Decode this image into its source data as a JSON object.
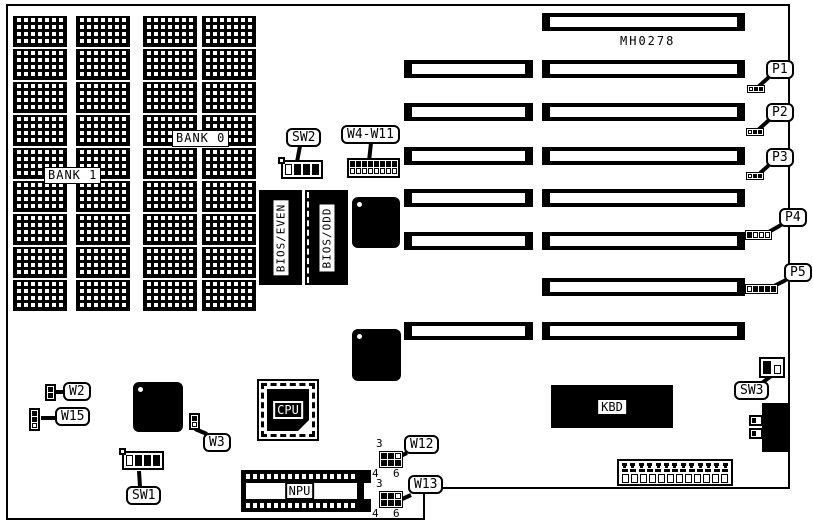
{
  "board": {
    "id": "MH0278",
    "banks": {
      "bank0": "BANK 0",
      "bank1": "BANK 1"
    },
    "memory": {
      "columns": 4,
      "chips_per_column": 9
    },
    "chips": {
      "cpu": "CPU",
      "npu": "NPU",
      "kbd": "KBD",
      "bios_even": "BIOS/EVEN",
      "bios_odd": "BIOS/ODD"
    },
    "switches": {
      "sw1": "SW1",
      "sw2": "SW2",
      "sw3": "SW3"
    },
    "jumpers": {
      "w2": "W2",
      "w3": "W3",
      "w15": "W15",
      "w4_w11": "W4-W11",
      "w12": "W12",
      "w13": "W13"
    },
    "pin_numbers": {
      "three": "3",
      "four": "4",
      "six": "6"
    },
    "edge_connectors": [
      {
        "id": "P1",
        "cells": [
          "open",
          "filled",
          "filled"
        ]
      },
      {
        "id": "P2",
        "cells": [
          "open",
          "filled",
          "filled"
        ]
      },
      {
        "id": "P3",
        "cells": [
          "open",
          "filled",
          "filled"
        ]
      },
      {
        "id": "P4",
        "cells": [
          "filled",
          "open",
          "open",
          "open"
        ]
      },
      {
        "id": "P5",
        "cells": [
          "open",
          "filled",
          "filled",
          "filled",
          "filled"
        ]
      }
    ],
    "slots": {
      "rows": [
        {
          "left": false,
          "right": true
        },
        {
          "left": true,
          "right": true
        },
        {
          "left": true,
          "right": true
        },
        {
          "left": true,
          "right": true
        },
        {
          "left": true,
          "right": true
        },
        {
          "left": true,
          "right": true
        },
        {
          "left": false,
          "right": true
        },
        {
          "left": true,
          "right": true
        }
      ]
    },
    "bottom_connector": {
      "top_pins": 13,
      "mid_pins": 13,
      "sockets": 12
    },
    "colors": {
      "ink": "#000000",
      "paper": "#ffffff"
    }
  }
}
